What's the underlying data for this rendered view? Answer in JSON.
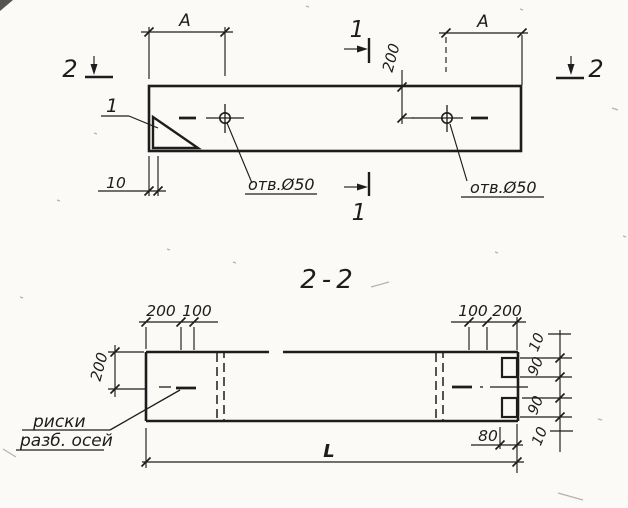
{
  "drawing": {
    "colors": {
      "line": "#1d1d1d",
      "paper": "#fbfaf7"
    },
    "top_view": {
      "dim_a_left": "A",
      "dim_a_right": "A",
      "dim_200": "200",
      "dim_10": "10",
      "callout_1": "1",
      "section1_top": "1",
      "section1_bottom": "1",
      "section2_left": "2",
      "section2_right": "2",
      "hole_label_left": "отв.Ø50",
      "hole_label_right": "отв.Ø50"
    },
    "section_view": {
      "title": "2-2",
      "dim_top_left_200": "200",
      "dim_top_left_100": "100",
      "dim_top_right_100": "100",
      "dim_top_right_200": "200",
      "dim_left_200": "200",
      "dims_right": [
        "10",
        "90",
        "90",
        "10"
      ],
      "dim_80": "80",
      "dim_length": "L",
      "note_line1": "риски",
      "note_line2": "разб. осей"
    }
  }
}
